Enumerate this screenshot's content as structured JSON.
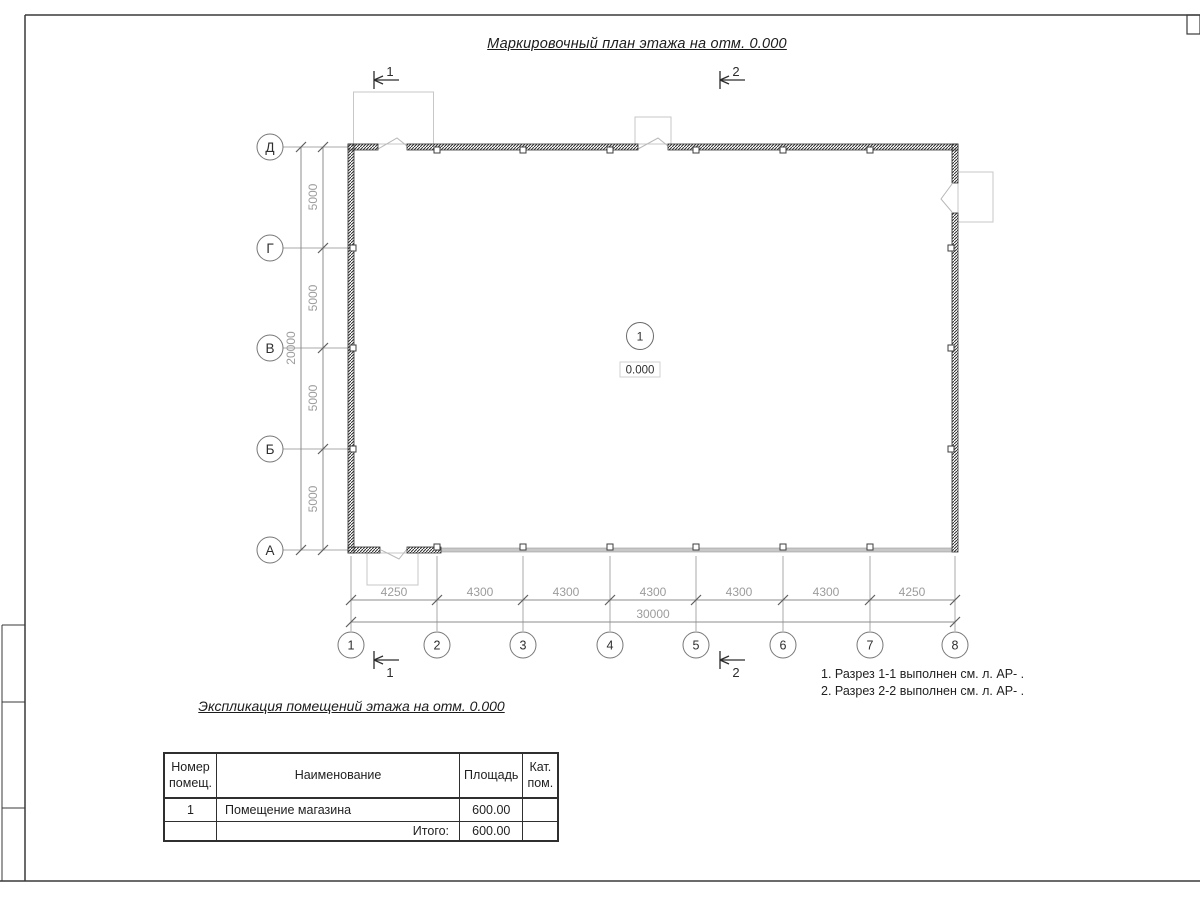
{
  "titles": {
    "plan": "Маркировочный план этажа на отм. 0.000",
    "table": "Экспликация помещений этажа на отм. 0.000"
  },
  "plan": {
    "room_number": "1",
    "elevation": "0.000",
    "row_axes": [
      "Д",
      "Г",
      "В",
      "Б",
      "А"
    ],
    "col_axes": [
      "1",
      "2",
      "3",
      "4",
      "5",
      "6",
      "7",
      "8"
    ],
    "v_segments": [
      "5000",
      "5000",
      "5000",
      "5000"
    ],
    "v_total": "20000",
    "h_segments": [
      "4250",
      "4300",
      "4300",
      "4300",
      "4300",
      "4300",
      "4250"
    ],
    "h_total": "30000",
    "section1": "1",
    "section2": "2"
  },
  "notes": {
    "line1": "1. Разрез 1-1 выполнен см. л. АР- .",
    "line2": "2. Разрез 2-2 выполнен см. л. АР- ."
  },
  "table": {
    "headers": [
      "Номер помещ.",
      "Наименование",
      "Площадь",
      "Кат. пом."
    ],
    "row1": {
      "number": "1",
      "name": "Помещение магазина",
      "area": "600.00",
      "cat": ""
    },
    "total": {
      "label": "Итого:",
      "area": "600.00",
      "cat": ""
    }
  }
}
